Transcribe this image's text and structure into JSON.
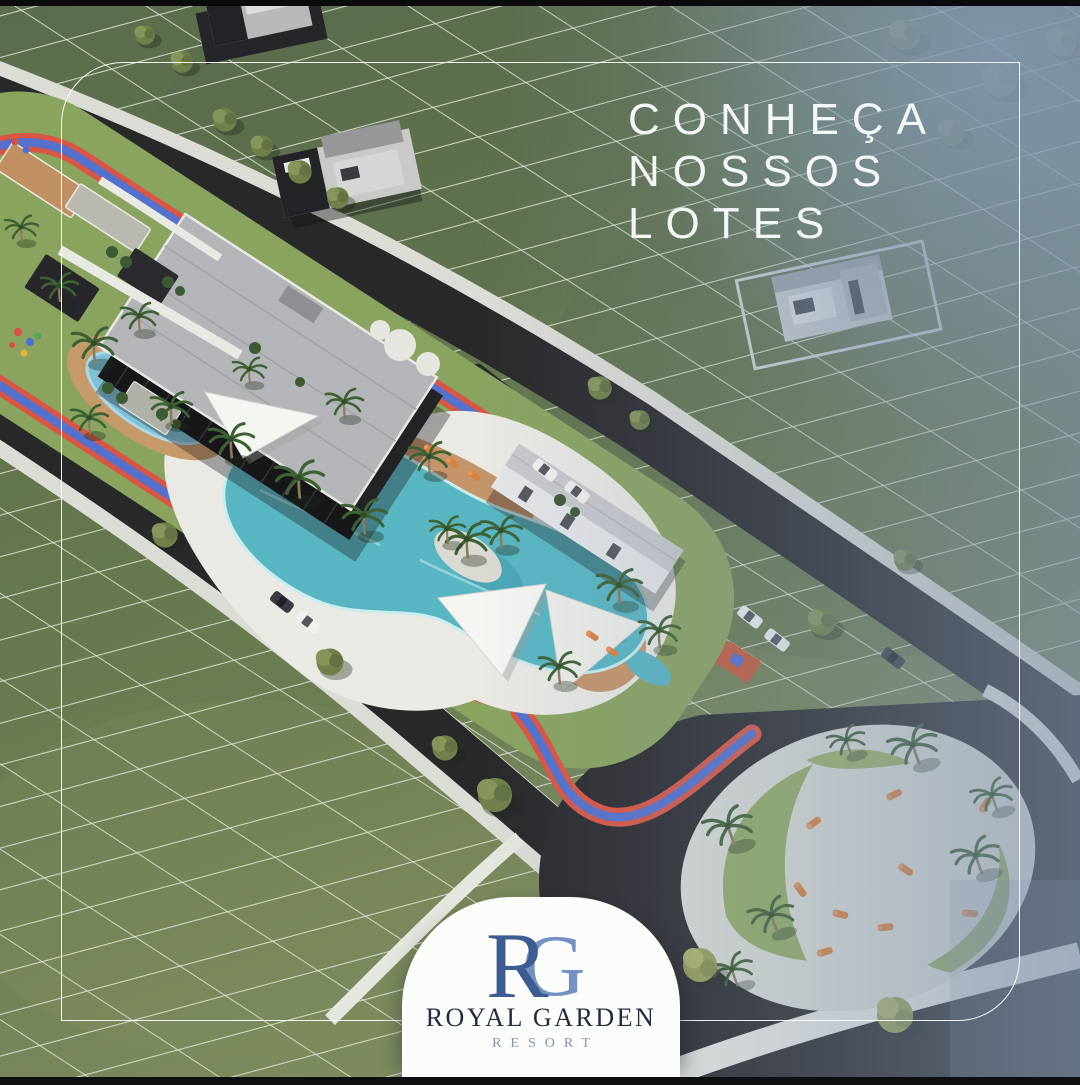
{
  "headline": {
    "lines": [
      "CONHEÇA",
      "NOSSOS",
      "LOTES"
    ],
    "text_color": "#f4f6f7"
  },
  "logo": {
    "monogram": {
      "first": "R",
      "second": "G",
      "first_color": "#3d5c92",
      "second_color": "#7591c1"
    },
    "name": "ROYAL GARDEN",
    "subtitle": "RESORT",
    "name_color": "#212d3d",
    "subtitle_color": "#8494ab",
    "card_background": "#fcfcfa"
  },
  "frame": {
    "border_color": "#ffffff",
    "top_bar_color": "#0b0b0d",
    "bottom_bar_color": "#0f0f11"
  },
  "scene": {
    "kind": "aerial-3d-render-of-master-plan",
    "features": [
      "residential-lot-grid",
      "clubhouse",
      "lagoon-pool",
      "kids-pool",
      "shade-sails",
      "jogging-track",
      "sport-courts",
      "pergolas",
      "internal-roads",
      "circular-leisure-plaza",
      "palm-trees",
      "model-houses",
      "parked-cars"
    ],
    "palette": {
      "grass": "#65774f",
      "lot_line": "#e3e6da",
      "road": "#29282b",
      "sidewalk": "#dcdcd6",
      "track_red": "#d95544",
      "track_blue": "#5570cd",
      "club_lawn": "#8aa35f",
      "deck": "#eae9e4",
      "wood_deck": "#c4946a",
      "pool_water": "#58b5c2",
      "clubhouse_roof": "#b4b5b8",
      "clubhouse_walls": "#232227",
      "plaza_concrete": "#dcddd7",
      "plaza_green": "#93ad63",
      "lounger_orange": "#d8813e",
      "haze_blue": "#7e92ab"
    }
  }
}
